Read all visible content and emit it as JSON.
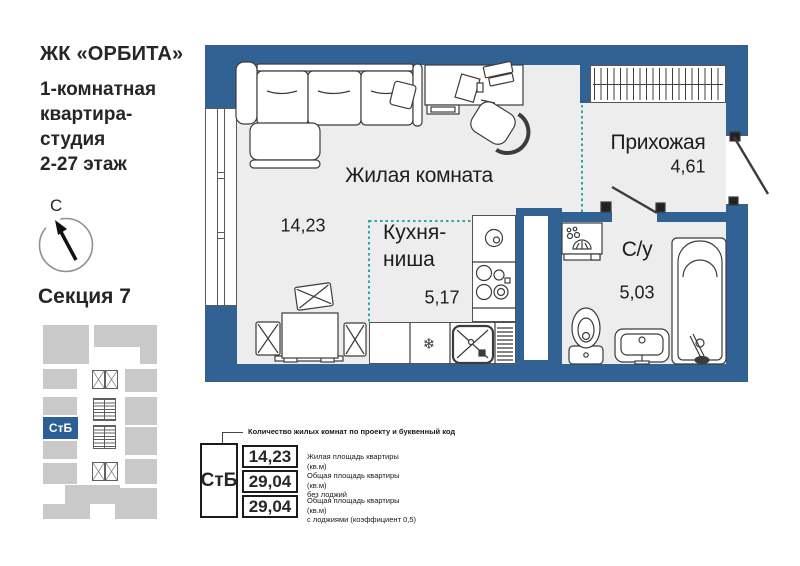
{
  "colors": {
    "wall_blue": "#326293",
    "teal_dashed": "#29a8a2",
    "floor_gray": "#ededed",
    "minimap_gray": "#c9c9c9",
    "unit_blue": "#2b5f95",
    "text_dark": "#262626"
  },
  "sidebar": {
    "complex_name": "ЖК «ОРБИТА»",
    "subtitle": "1-комнатная\nквартира-\nстудия\n2-27 этаж",
    "compass_north_label": "С",
    "section_label": "Секция 7",
    "minimap_unit_code": "СтБ"
  },
  "plan": {
    "fridge_symbol": "❄",
    "rooms": [
      {
        "name": "Жилая комната",
        "area": "14,23"
      },
      {
        "name": "Кухня-ниша",
        "area": "5,17"
      },
      {
        "name": "Прихожая",
        "area": "4,61"
      },
      {
        "name": "С/у",
        "area": "5,03"
      }
    ]
  },
  "legend": {
    "callout": "Количество жилых комнат по проекту и буквенный код",
    "unit_code": "СтБ",
    "rows": [
      {
        "value": "14,23",
        "label": "Жилая площадь квартиры (кв.м)"
      },
      {
        "value": "29,04",
        "label": "Общая площадь квартиры (кв.м)\nбез лоджий"
      },
      {
        "value": "29,04",
        "label": "Общая площадь квартиры (кв.м)\nс лоджиями (коэффициент 0,5)"
      }
    ]
  }
}
